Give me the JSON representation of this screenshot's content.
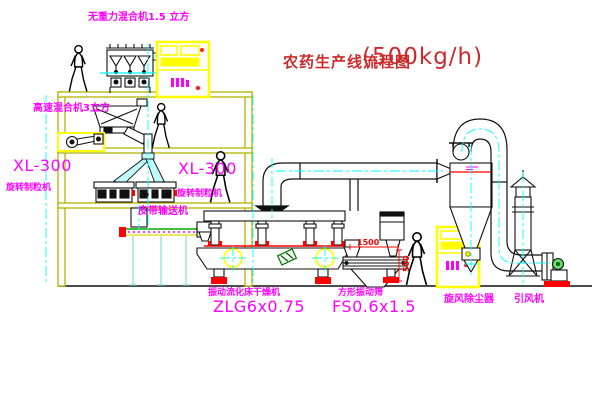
{
  "title": {
    "text": "农药生产线流程图",
    "capacity": "(500kg/h)"
  },
  "labels": {
    "gravity_mixer": "无重力混合机1.5 立方",
    "high_speed_mixer": "高速混合机3立方",
    "granulator_left_model": "XL-300",
    "granulator_left_name": "旋转制粒机",
    "granulator_center_model": "XL-300",
    "granulator_center_name": "旋转制粒机",
    "belt_conveyor": "皮带输送机",
    "dryer_name": "振动流化床干燥机",
    "dryer_model": "ZLG6x0.75",
    "sieve_name": "方形振动筛",
    "sieve_model": "FS0.6x1.5",
    "cyclone": "旋风除尘器",
    "fan": "引风机"
  },
  "dimensions": {
    "sieve_length": "1500",
    "sieve_outlet_height": "500"
  },
  "colors": {
    "label_magenta": "#ff00ff",
    "title_red": "#cc2b2b",
    "frame_olive": "#b3b300",
    "cabinet_yellow": "#ffff00",
    "centerline_cyan": "#00ffff",
    "accent_red": "#ff0000"
  }
}
